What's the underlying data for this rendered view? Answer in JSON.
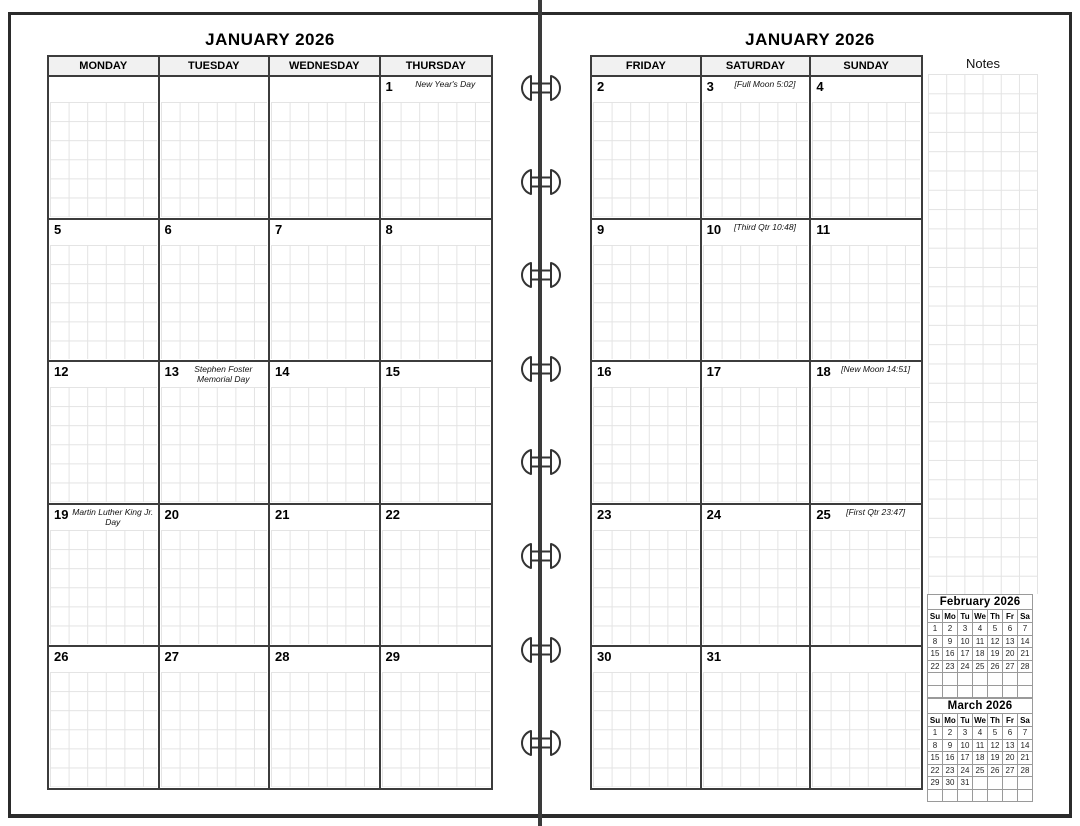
{
  "left_page": {
    "title": "JANUARY 2026",
    "day_headers": [
      "MONDAY",
      "TUESDAY",
      "WEDNESDAY",
      "THURSDAY"
    ],
    "weeks": [
      [
        {
          "num": "",
          "note": ""
        },
        {
          "num": "",
          "note": ""
        },
        {
          "num": "",
          "note": ""
        },
        {
          "num": "1",
          "note": "New Year's Day"
        }
      ],
      [
        {
          "num": "5",
          "note": ""
        },
        {
          "num": "6",
          "note": ""
        },
        {
          "num": "7",
          "note": ""
        },
        {
          "num": "8",
          "note": ""
        }
      ],
      [
        {
          "num": "12",
          "note": ""
        },
        {
          "num": "13",
          "note": "Stephen Foster Memorial Day"
        },
        {
          "num": "14",
          "note": ""
        },
        {
          "num": "15",
          "note": ""
        }
      ],
      [
        {
          "num": "19",
          "note": "Martin Luther King Jr. Day"
        },
        {
          "num": "20",
          "note": ""
        },
        {
          "num": "21",
          "note": ""
        },
        {
          "num": "22",
          "note": ""
        }
      ],
      [
        {
          "num": "26",
          "note": ""
        },
        {
          "num": "27",
          "note": ""
        },
        {
          "num": "28",
          "note": ""
        },
        {
          "num": "29",
          "note": ""
        }
      ]
    ]
  },
  "right_page": {
    "title": "JANUARY 2026",
    "notes_label": "Notes",
    "day_headers": [
      "FRIDAY",
      "SATURDAY",
      "SUNDAY"
    ],
    "weeks": [
      [
        {
          "num": "2",
          "note": ""
        },
        {
          "num": "3",
          "note": "[Full Moon 5:02]"
        },
        {
          "num": "4",
          "note": ""
        }
      ],
      [
        {
          "num": "9",
          "note": ""
        },
        {
          "num": "10",
          "note": "[Third Qtr 10:48]"
        },
        {
          "num": "11",
          "note": ""
        }
      ],
      [
        {
          "num": "16",
          "note": ""
        },
        {
          "num": "17",
          "note": ""
        },
        {
          "num": "18",
          "note": "[New Moon 14:51]"
        }
      ],
      [
        {
          "num": "23",
          "note": ""
        },
        {
          "num": "24",
          "note": ""
        },
        {
          "num": "25",
          "note": "[First Qtr 23:47]"
        }
      ],
      [
        {
          "num": "30",
          "note": ""
        },
        {
          "num": "31",
          "note": ""
        },
        {
          "num": "",
          "note": ""
        }
      ]
    ]
  },
  "mini_calendars": [
    {
      "title": "February 2026",
      "day_headers": [
        "Su",
        "Mo",
        "Tu",
        "We",
        "Th",
        "Fr",
        "Sa"
      ],
      "weeks": [
        [
          "1",
          "2",
          "3",
          "4",
          "5",
          "6",
          "7"
        ],
        [
          "8",
          "9",
          "10",
          "11",
          "12",
          "13",
          "14"
        ],
        [
          "15",
          "16",
          "17",
          "18",
          "19",
          "20",
          "21"
        ],
        [
          "22",
          "23",
          "24",
          "25",
          "26",
          "27",
          "28"
        ],
        [
          "",
          "",
          "",
          "",
          "",
          "",
          ""
        ],
        [
          "",
          "",
          "",
          "",
          "",
          "",
          ""
        ]
      ]
    },
    {
      "title": "March 2026",
      "day_headers": [
        "Su",
        "Mo",
        "Tu",
        "We",
        "Th",
        "Fr",
        "Sa"
      ],
      "weeks": [
        [
          "1",
          "2",
          "3",
          "4",
          "5",
          "6",
          "7"
        ],
        [
          "8",
          "9",
          "10",
          "11",
          "12",
          "13",
          "14"
        ],
        [
          "15",
          "16",
          "17",
          "18",
          "19",
          "20",
          "21"
        ],
        [
          "22",
          "23",
          "24",
          "25",
          "26",
          "27",
          "28"
        ],
        [
          "29",
          "30",
          "31",
          "",
          "",
          "",
          ""
        ],
        [
          "",
          "",
          "",
          "",
          "",
          "",
          ""
        ]
      ]
    }
  ],
  "binding": {
    "ring_count": 8
  },
  "colors": {
    "table_border": "#3c3c3c",
    "grid_line": "#e3e3e3",
    "header_bg": "#f1f1f1",
    "mini_border": "#9a9a9a",
    "spine": "#3a3a3a"
  }
}
